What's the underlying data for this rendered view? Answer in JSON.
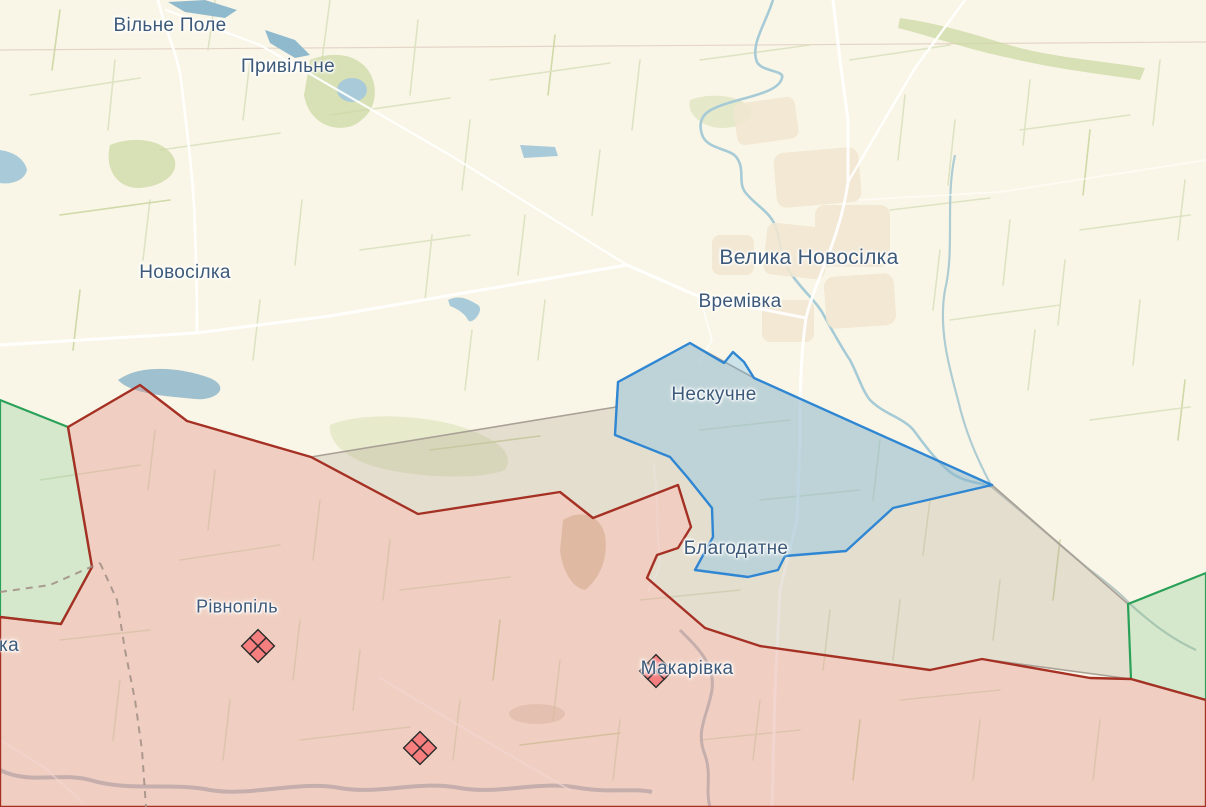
{
  "app": {
    "view": "war-map-canvas"
  },
  "map": {
    "background_color": "#faf6e7",
    "label_color": "#3d5a7a",
    "labels": [
      {
        "id": "vilne-pole",
        "name": "Вільне Поле",
        "x": 170,
        "y": 26,
        "font_size": 19
      },
      {
        "id": "pryvilne",
        "name": "Привільне",
        "x": 288,
        "y": 67,
        "font_size": 19
      },
      {
        "id": "novosilka",
        "name": "Новосілка",
        "x": 185,
        "y": 273,
        "font_size": 19
      },
      {
        "id": "velyka-novosilka",
        "name": "Велика Новосілка",
        "x": 809,
        "y": 258,
        "font_size": 21
      },
      {
        "id": "vremivka",
        "name": "Времівка",
        "x": 740,
        "y": 302,
        "font_size": 19
      },
      {
        "id": "neskuchne",
        "name": "Нескучне",
        "x": 714,
        "y": 395,
        "font_size": 19
      },
      {
        "id": "blahodatne",
        "name": "Благодатне",
        "x": 736,
        "y": 549,
        "font_size": 19
      },
      {
        "id": "rivnopil",
        "name": "Рівнопіль",
        "x": 237,
        "y": 607,
        "font_size": 18
      },
      {
        "id": "makarivka",
        "name": "Макарівка",
        "x": 687,
        "y": 669,
        "font_size": 19
      },
      {
        "id": "clipped-west",
        "name": "ка",
        "x": 9,
        "y": 646,
        "font_size": 19
      }
    ],
    "markers": [
      {
        "id": "fortification-cluster-1",
        "x": 258,
        "y": 646
      },
      {
        "id": "fortification-cluster-2",
        "x": 656,
        "y": 671
      },
      {
        "id": "fortification-cluster-3",
        "x": 420,
        "y": 748
      }
    ],
    "marker_style": {
      "fill": "#f57f7f",
      "stroke": "#2b2b2b"
    },
    "zones": [
      {
        "id": "contested-gray",
        "stroke": "#a9a096",
        "fill": "rgba(180,165,150,0.30)",
        "stroke_width": 1.6
      },
      {
        "id": "defense-green-west",
        "stroke": "#2aa158",
        "fill": "rgba(130,200,140,0.30)",
        "stroke_width": 2.2
      },
      {
        "id": "defense-green-east",
        "stroke": "#2aa158",
        "fill": "rgba(130,200,140,0.30)",
        "stroke_width": 2.2
      },
      {
        "id": "occupied-red",
        "stroke": "#a53125",
        "fill": "rgba(225,150,140,0.40)",
        "stroke_width": 2.4
      },
      {
        "id": "liberated-blue",
        "stroke": "#2f86d2",
        "fill": "rgba(110,190,235,0.32)",
        "stroke_width": 2.4
      }
    ]
  }
}
